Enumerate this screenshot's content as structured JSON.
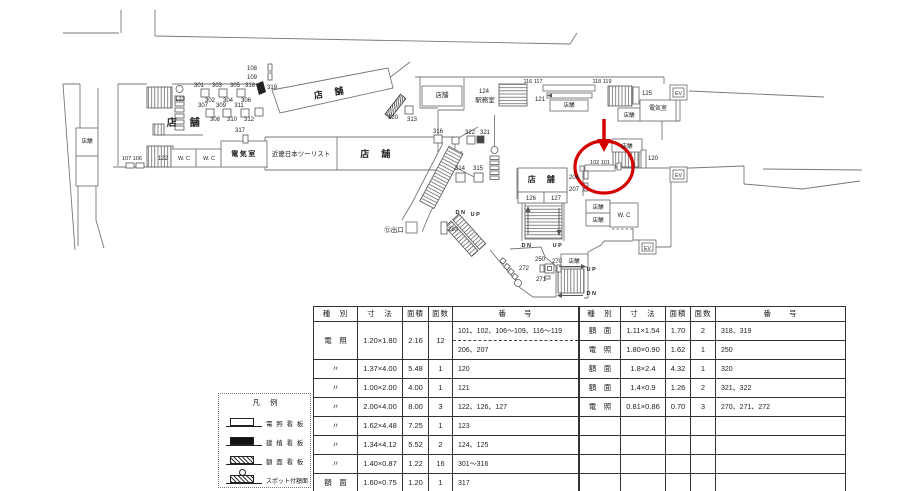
{
  "plan": {
    "colors": {
      "line": "#777777",
      "red": "#d40000",
      "text": "#222222"
    },
    "red_marker": {
      "circled_text": "102 101"
    },
    "labels": [
      {
        "t": "108",
        "x": 252,
        "y": 70
      },
      {
        "t": "109",
        "x": 252,
        "y": 79
      },
      {
        "t": "318",
        "x": 250,
        "y": 87
      },
      {
        "t": "319",
        "x": 272,
        "y": 89
      },
      {
        "t": "301",
        "x": 199,
        "y": 87
      },
      {
        "t": "303",
        "x": 217,
        "y": 87
      },
      {
        "t": "305",
        "x": 235,
        "y": 87
      },
      {
        "t": "302",
        "x": 210,
        "y": 102
      },
      {
        "t": "304",
        "x": 228,
        "y": 102
      },
      {
        "t": "306",
        "x": 246,
        "y": 102
      },
      {
        "t": "307",
        "x": 203,
        "y": 107
      },
      {
        "t": "309",
        "x": 221,
        "y": 107
      },
      {
        "t": "311",
        "x": 239,
        "y": 107
      },
      {
        "t": "308",
        "x": 215,
        "y": 121
      },
      {
        "t": "310",
        "x": 232,
        "y": 121
      },
      {
        "t": "312",
        "x": 249,
        "y": 121
      },
      {
        "t": "123",
        "x": 180,
        "y": 101
      },
      {
        "t": "店　舗",
        "x": 184,
        "y": 126,
        "s": 10,
        "b": 1
      },
      {
        "t": "317",
        "x": 240,
        "y": 132
      },
      {
        "t": "107 106",
        "x": 132,
        "y": 160,
        "s": 5.5
      },
      {
        "t": "122",
        "x": 163,
        "y": 160
      },
      {
        "t": "W. C",
        "x": 184,
        "y": 160,
        "s": 5.5
      },
      {
        "t": "W. C",
        "x": 209,
        "y": 160,
        "s": 5.5
      },
      {
        "t": "電気室",
        "x": 244,
        "y": 156,
        "s": 7,
        "b": 1
      },
      {
        "t": "店舗",
        "x": 87,
        "y": 143,
        "s": 5.5
      },
      {
        "t": "店　舗",
        "x": 330,
        "y": 96,
        "s": 9,
        "b": 1,
        "r": -10
      },
      {
        "t": "320",
        "x": 393,
        "y": 119
      },
      {
        "t": "313",
        "x": 412,
        "y": 121
      },
      {
        "t": "近畿日本ツーリスト",
        "x": 301,
        "y": 156,
        "s": 6.5
      },
      {
        "t": "店　舗",
        "x": 376,
        "y": 157,
        "s": 9,
        "b": 1
      },
      {
        "t": "店舗",
        "x": 442,
        "y": 97,
        "s": 6.5
      },
      {
        "t": "124",
        "x": 484,
        "y": 93
      },
      {
        "t": "駅務室",
        "x": 485,
        "y": 102,
        "s": 6.5
      },
      {
        "t": "116 117",
        "x": 533,
        "y": 83,
        "s": 5.5
      },
      {
        "t": "121",
        "x": 540,
        "y": 101
      },
      {
        "t": "店舗",
        "x": 569,
        "y": 107,
        "s": 5.5
      },
      {
        "t": "118 119",
        "x": 602,
        "y": 83,
        "s": 5.5
      },
      {
        "t": "125",
        "x": 647,
        "y": 95
      },
      {
        "t": "店舗",
        "x": 629,
        "y": 117,
        "s": 5.5
      },
      {
        "t": "電気室",
        "x": 658,
        "y": 110,
        "s": 6
      },
      {
        "t": "EV",
        "x": 678.5,
        "y": 95,
        "s": 5
      },
      {
        "t": "EV",
        "x": 678.5,
        "y": 177,
        "s": 5
      },
      {
        "t": "EV",
        "x": 647.5,
        "y": 250,
        "s": 5
      },
      {
        "t": "316",
        "x": 438,
        "y": 133
      },
      {
        "t": "322",
        "x": 470,
        "y": 134
      },
      {
        "t": "321",
        "x": 485,
        "y": 134
      },
      {
        "t": "314",
        "x": 460,
        "y": 170
      },
      {
        "t": "315",
        "x": 478,
        "y": 170
      },
      {
        "t": "DN",
        "x": 461,
        "y": 214,
        "s": 5.5,
        "b": 1
      },
      {
        "t": "UP",
        "x": 476,
        "y": 216,
        "s": 5.5,
        "b": 1
      },
      {
        "t": "283",
        "x": 453,
        "y": 231
      },
      {
        "t": "⑫出口",
        "x": 394,
        "y": 232,
        "s": 6.5
      },
      {
        "t": "店　舗",
        "x": 542,
        "y": 182,
        "s": 8,
        "b": 1
      },
      {
        "t": "126",
        "x": 531,
        "y": 200
      },
      {
        "t": "127",
        "x": 556,
        "y": 200
      },
      {
        "t": "DN",
        "x": 527,
        "y": 247,
        "s": 5.5,
        "b": 1
      },
      {
        "t": "UP",
        "x": 558,
        "y": 247,
        "s": 5.5,
        "b": 1
      },
      {
        "t": "206",
        "x": 574,
        "y": 179
      },
      {
        "t": "207",
        "x": 574,
        "y": 191
      },
      {
        "t": "102 101",
        "x": 600,
        "y": 164,
        "s": 5.5
      },
      {
        "t": "店舗",
        "x": 627,
        "y": 148,
        "s": 5.5
      },
      {
        "t": "120",
        "x": 653,
        "y": 160
      },
      {
        "t": "店舗",
        "x": 598,
        "y": 209,
        "s": 5.5
      },
      {
        "t": "店舗",
        "x": 598,
        "y": 222,
        "s": 5.5
      },
      {
        "t": "W. C",
        "x": 624,
        "y": 217,
        "s": 6
      },
      {
        "t": "250",
        "x": 540,
        "y": 261
      },
      {
        "t": "270",
        "x": 557,
        "y": 263
      },
      {
        "t": "272",
        "x": 524,
        "y": 270
      },
      {
        "t": "271",
        "x": 541,
        "y": 281
      },
      {
        "t": "店舗",
        "x": 574,
        "y": 263,
        "s": 5.5
      },
      {
        "t": "UP",
        "x": 592,
        "y": 271,
        "s": 5.5,
        "b": 1
      },
      {
        "t": "DN",
        "x": 592,
        "y": 295,
        "s": 5.5,
        "b": 1
      }
    ]
  },
  "legend": {
    "title": "凡 例",
    "items": [
      {
        "label": "電 照 看 板",
        "type": "densho"
      },
      {
        "label": "建 植 看 板",
        "type": "kenshoku"
      },
      {
        "label": "額 面 看 板",
        "type": "gakumen"
      },
      {
        "label": "スポット付額面",
        "type": "spot"
      }
    ]
  },
  "tables": {
    "headers": [
      "種　別",
      "寸　法",
      "面積",
      "面数",
      "番　　号"
    ],
    "left": {
      "rows": [
        {
          "type": "電　照",
          "size": "1.20×1.80",
          "area": "2.16",
          "faces": "12",
          "numbers": "101、102、106〜109、116〜119",
          "numbers2": "206、207"
        },
        {
          "type": "〃",
          "size": "1.37×4.00",
          "area": "5.48",
          "faces": "1",
          "numbers": "120"
        },
        {
          "type": "〃",
          "size": "1.00×2.00",
          "area": "4.00",
          "faces": "1",
          "numbers": "121"
        },
        {
          "type": "〃",
          "size": "2.00×4.00",
          "area": "8.00",
          "faces": "3",
          "numbers": "122、126、127"
        },
        {
          "type": "〃",
          "size": "1.62×4.48",
          "area": "7.25",
          "faces": "1",
          "numbers": "123"
        },
        {
          "type": "〃",
          "size": "1.34×4.12",
          "area": "5.52",
          "faces": "2",
          "numbers": "124、125"
        },
        {
          "type": "〃",
          "size": "1.40×0.87",
          "area": "1.22",
          "faces": "16",
          "numbers": "301〜316"
        },
        {
          "type": "額　面",
          "size": "1.60×0.75",
          "area": "1.20",
          "faces": "1",
          "numbers": "317"
        }
      ]
    },
    "right": {
      "rows": [
        {
          "type": "額　面",
          "size": "1.11×1.54",
          "area": "1.70",
          "faces": "2",
          "numbers": "318、319"
        },
        {
          "type": "電　照",
          "size": "1.80×0.90",
          "area": "1.62",
          "faces": "1",
          "numbers": "250"
        },
        {
          "type": "額　面",
          "size": "1.8×2.4",
          "area": "4.32",
          "faces": "1",
          "numbers": "320"
        },
        {
          "type": "額　面",
          "size": "1.4×0.9",
          "area": "1.26",
          "faces": "2",
          "numbers": "321、322"
        },
        {
          "type": "電　照",
          "size": "0.81×0.86",
          "area": "0.70",
          "faces": "3",
          "numbers": "270、271、272"
        },
        {
          "type": "",
          "size": "",
          "area": "",
          "faces": "",
          "numbers": ""
        },
        {
          "type": "",
          "size": "",
          "area": "",
          "faces": "",
          "numbers": ""
        },
        {
          "type": "",
          "size": "",
          "area": "",
          "faces": "",
          "numbers": ""
        },
        {
          "type": "",
          "size": "",
          "area": "",
          "faces": "",
          "numbers": ""
        }
      ]
    }
  }
}
